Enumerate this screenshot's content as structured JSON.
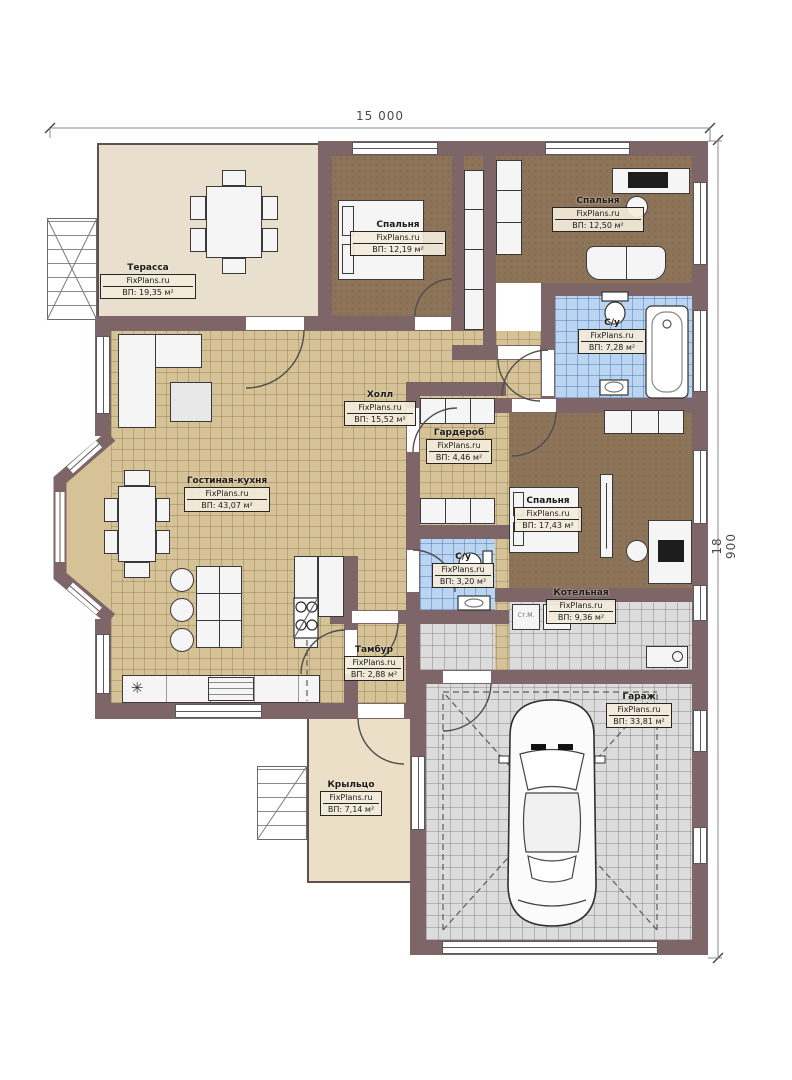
{
  "dimensions": {
    "width": "15 000",
    "height": "18 900"
  },
  "watermark": "FixPlans.ru",
  "rooms": [
    {
      "name": "Терасса",
      "area": "ВП: 19,35 м²"
    },
    {
      "name": "Спальня",
      "area": "ВП: 12,19 м²"
    },
    {
      "name": "Спальня",
      "area": "ВП: 12,50 м²"
    },
    {
      "name": "С/у",
      "area": "ВП: 7,28 м²"
    },
    {
      "name": "Холл",
      "area": "ВП: 15,52 м²"
    },
    {
      "name": "Гардероб",
      "area": "ВП: 4,46 м²"
    },
    {
      "name": "Спальня",
      "area": "ВП: 17,43 м²"
    },
    {
      "name": "Гостиная-кухня",
      "area": "ВП: 43,07 м²"
    },
    {
      "name": "С/у",
      "area": "ВП: 3,20 м²"
    },
    {
      "name": "Котельная",
      "area": "ВП: 9,36 м²"
    },
    {
      "name": "Тамбур",
      "area": "ВП: 2,88 м²"
    },
    {
      "name": "Гараж",
      "area": "ВП: 33,81 м²"
    },
    {
      "name": "Крыльцо",
      "area": "ВП: 7,14 м²"
    }
  ],
  "labels": {
    "washing_machine": "Ст.М."
  },
  "icons": {
    "sink_star": "✳"
  },
  "colors": {
    "wall": "#7e6567",
    "tile_beige": "#d5c297",
    "tile_blue": "#bad5f1",
    "tile_grey": "#dcdcdc",
    "bedroom_floor": "#8d7458",
    "terrace_floor": "#e9dfcd",
    "porch_floor": "#ecdfc7"
  }
}
